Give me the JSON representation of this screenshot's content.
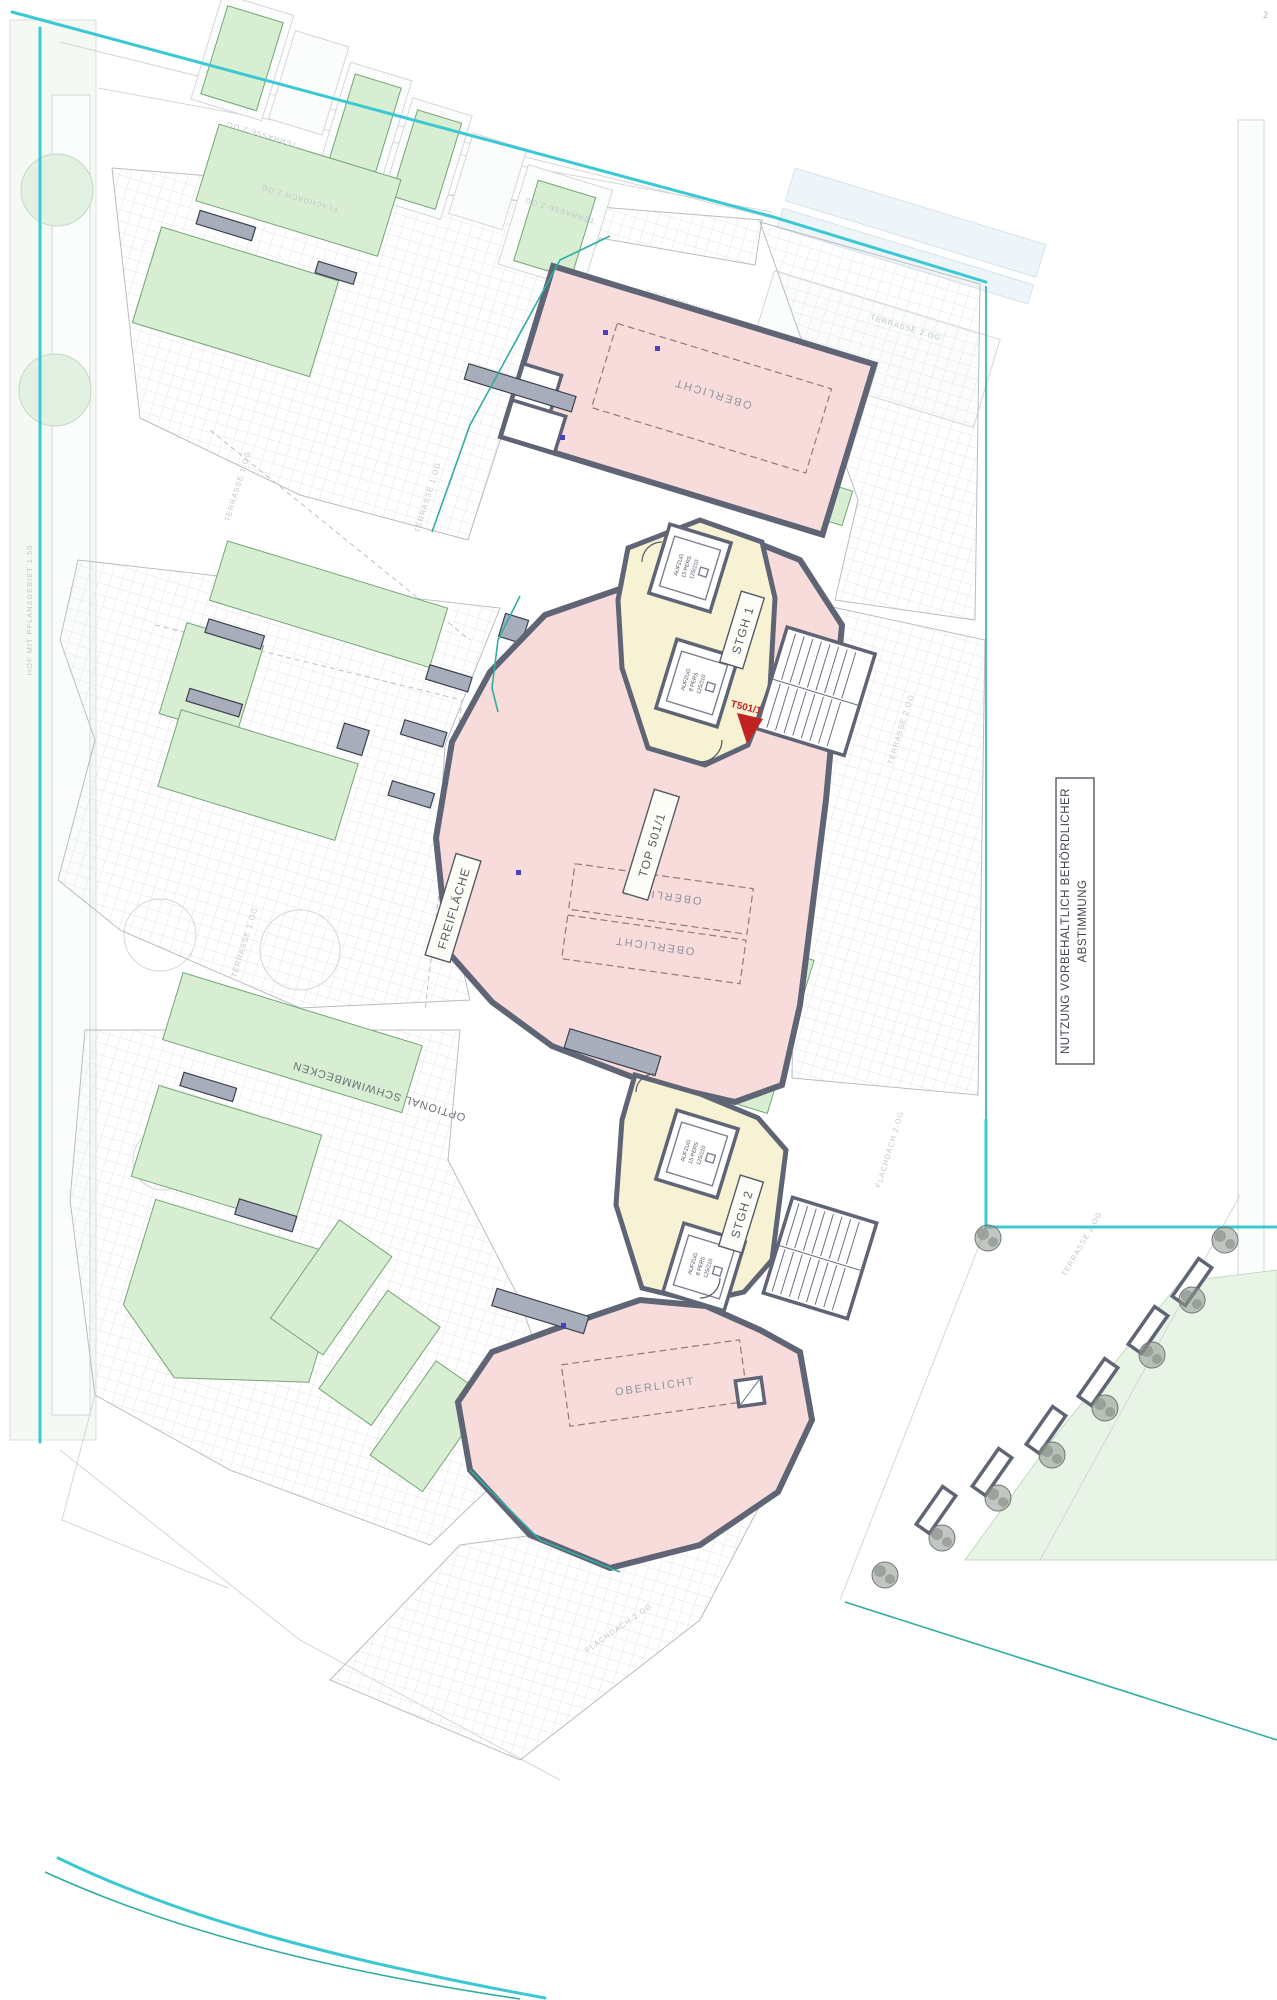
{
  "plan": {
    "unit": "TOP 501/1",
    "entrance": "T501/1",
    "stair1": "STGH 1",
    "stair2": "STGH 2",
    "skylight": "OBERLICHT",
    "open_area": "FREIFLÄCHE",
    "pool": "OPTIONAL SCHWIMMBECKEN",
    "note1": "NUTZUNG VORBEHALTLICH BEHÖRDLICHER",
    "note2": "ABSTIMMUNG",
    "corner_mark": "2"
  },
  "elevator": {
    "name": "AUFZUG",
    "persons_large": "15 PERS",
    "persons_small": "8 PERS",
    "cabin_size": "125/210"
  },
  "context_labels": {
    "terrace_2og": "TERRASSE 2.OG",
    "terrace_1og": "TERRASSE 1.OG",
    "flat_roof_2og": "FLACHDACH 2.OG",
    "courtyard": "HOF MIT PFLANZGEBIET 1:50"
  },
  "colors": {
    "roof_pink": "#f8dcdc",
    "stair_yellow": "#f7f2d3",
    "planter_green": "#d8eed3",
    "boundary_cyan": "#3cc8d2",
    "entrance_red": "#c32222"
  }
}
